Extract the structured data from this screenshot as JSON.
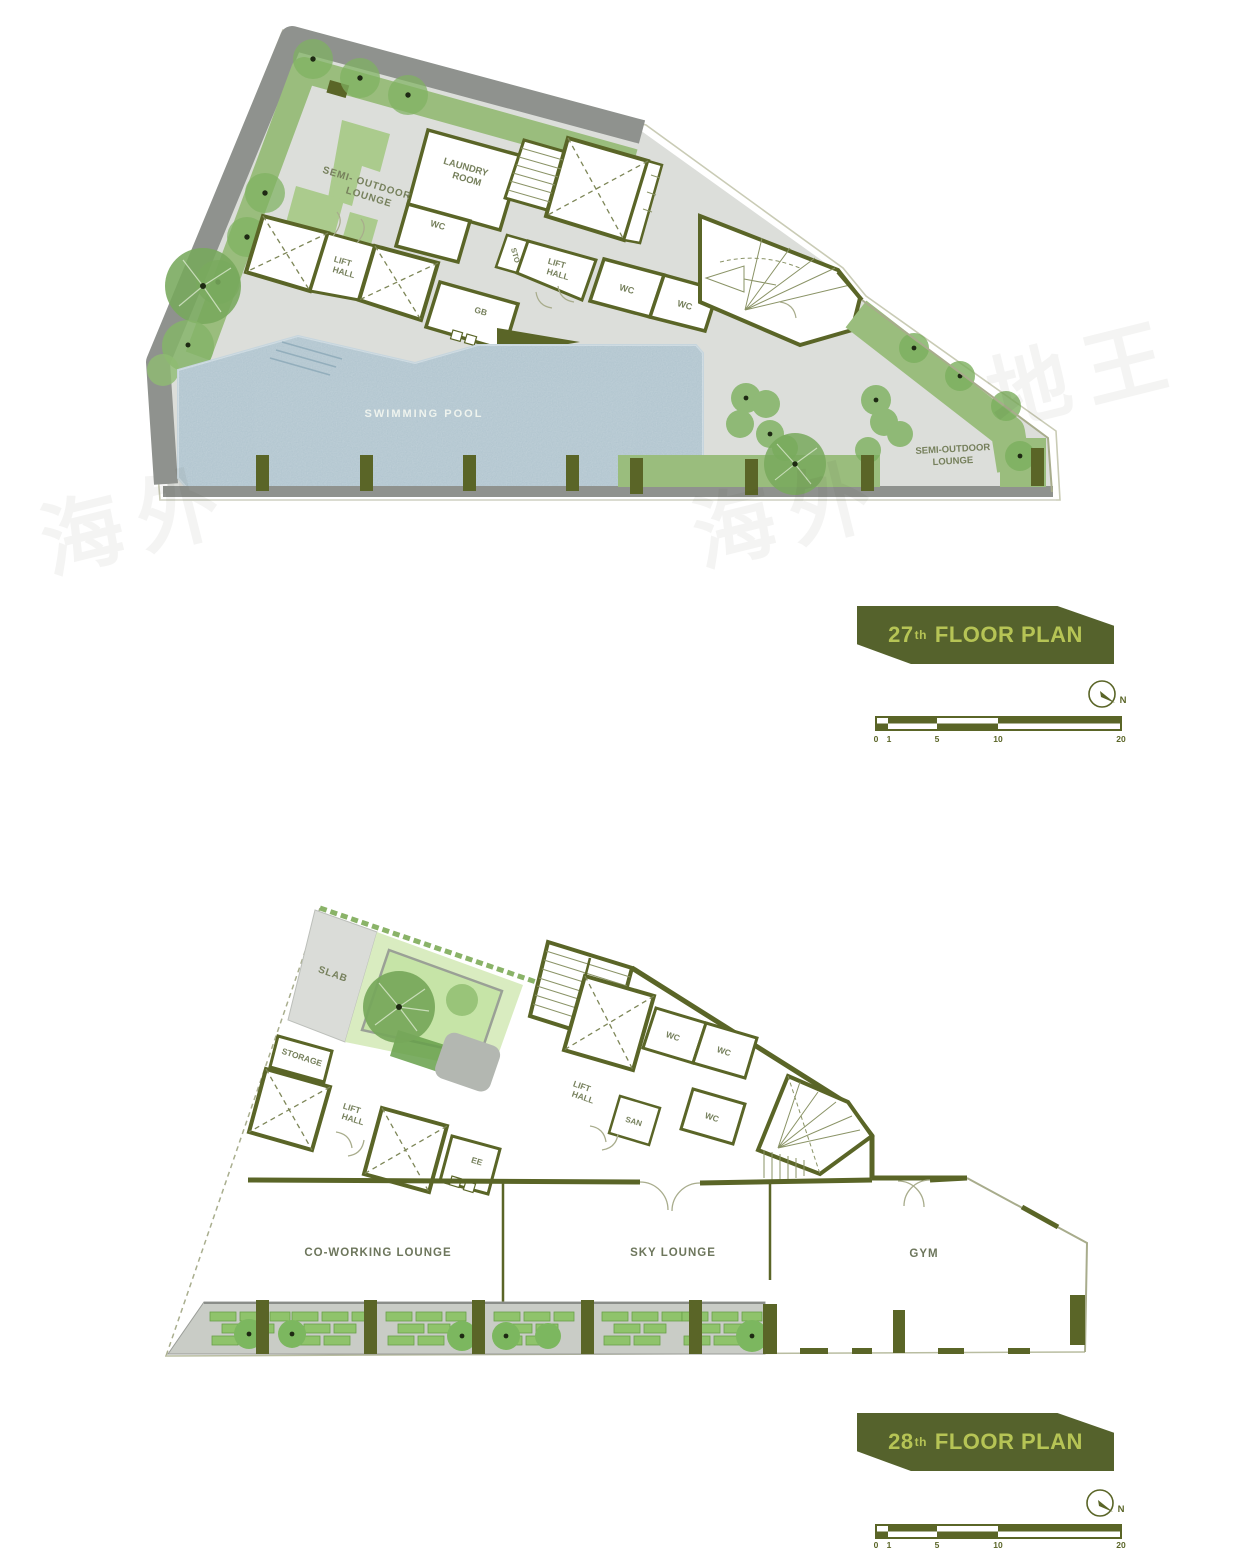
{
  "colors": {
    "wall": "#5a6527",
    "banner": "#55622c",
    "banner_text": "#b6c455",
    "floor": "#dcdeda",
    "roof": "#8f928e",
    "green_band": "#9abd7d",
    "green_bush": "#7fb261",
    "garden": "#d9ecc0",
    "pool": "#a9bfca",
    "label": "#76805c"
  },
  "watermarks": [
    "海外",
    "海外",
    "地王"
  ],
  "plan27": {
    "title": {
      "number": "27",
      "ordinal": "th",
      "text": "FLOOR PLAN"
    },
    "labels": {
      "sol_left_1": "SEMI- OUTDOOR",
      "sol_left_2": "LOUNGE",
      "laundry_1": "LAUNDRY",
      "laundry_2": "ROOM",
      "wc_a": "WC",
      "wc_b": "WC",
      "wc_c": "WC",
      "sto": "STO",
      "gb": "GB",
      "lift_1": "LIFT",
      "lift_2": "HALL",
      "pool": "SWIMMING POOL",
      "sol_right_1": "SEMI-OUTDOOR",
      "sol_right_2": "LOUNGE"
    },
    "compass": "N",
    "scale": [
      "0",
      "1",
      "5",
      "10",
      "20"
    ]
  },
  "plan28": {
    "title": {
      "number": "28",
      "ordinal": "th",
      "text": "FLOOR PLAN"
    },
    "labels": {
      "slab": "SLAB",
      "storage": "STORAGE",
      "lift_1": "LIFT",
      "lift_2": "HALL",
      "ee": "EE",
      "san": "SAN",
      "wc_a": "WC",
      "wc_b": "WC",
      "wc_c": "WC",
      "coworking": "CO-WORKING LOUNGE",
      "sky": "SKY LOUNGE",
      "gym": "GYM"
    },
    "compass": "N",
    "scale": [
      "0",
      "1",
      "5",
      "10",
      "20"
    ]
  }
}
